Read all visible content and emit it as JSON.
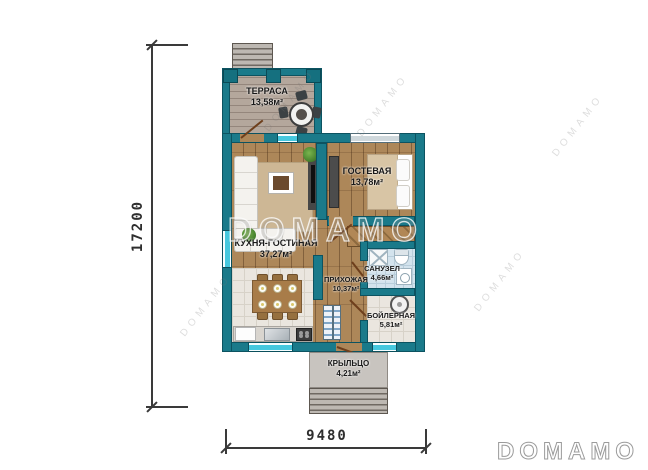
{
  "plan": {
    "dimensions": {
      "vertical": "17200",
      "horizontal": "9480"
    },
    "rooms": [
      {
        "name": "ТЕРРАСА",
        "area": "13,58м²"
      },
      {
        "name": "КУХНЯ-ГОСТИНАЯ",
        "area": "37,27м²"
      },
      {
        "name": "ГОСТЕВАЯ",
        "area": "13,78м²"
      },
      {
        "name": "ПРИХОЖАЯ",
        "area": "10,37м²"
      },
      {
        "name": "САНУЗЕЛ",
        "area": "4,66м²"
      },
      {
        "name": "БОЙЛЕРНАЯ",
        "area": "5,81м²"
      },
      {
        "name": "КРЫЛЬЦО",
        "area": "4,21м²"
      }
    ],
    "watermark": {
      "center_text": "DOMAMO",
      "logo_text": "DOMAMO",
      "diagonal_text": "DOMAMO"
    },
    "colors": {
      "wall": "#1a7a8a",
      "window_glass": "#45c8de",
      "wood_floor": "#ad8759",
      "tile_floor": "#eae6df",
      "bath_tile": "#d3e3ed",
      "terrace_floor": "#b4a79c",
      "porch_concrete": "#c8c4bf",
      "wall_outline": "#0c5361"
    }
  }
}
